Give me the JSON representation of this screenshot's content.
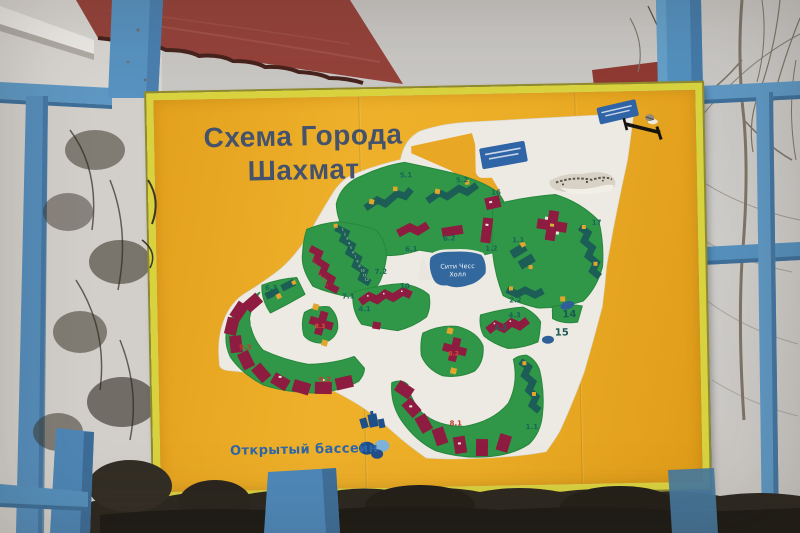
{
  "billboard": {
    "title_line1": "Схема Города",
    "title_line2": "Шахмат",
    "pool_label": "Открытый бассейн",
    "lake_label_line1": "Сити Чесс",
    "lake_label_line2": "Холл"
  },
  "map": {
    "block_labels": {
      "l51": "5.1",
      "l52": "5.2",
      "l16": "16",
      "l61": "6.1",
      "l62": "6.2",
      "l12": "1.2",
      "l72": "7.2",
      "l71": "7.1",
      "l63": "6.3",
      "l93": "9.3",
      "l92": "9.2",
      "l83": "8.3",
      "l10": "10",
      "l41": "4.1",
      "l82": "8.2",
      "l81": "8.1",
      "l11": "1.1",
      "l11b": "1.1",
      "l22": "2.2",
      "l17": "17",
      "l14": "14",
      "l15": "15",
      "l43": "4.3",
      "l43b": "4.3"
    },
    "units": [
      "1",
      "2",
      "3",
      "4",
      "5",
      "6",
      "7",
      "8",
      "9",
      "10",
      "11",
      "12"
    ]
  },
  "icons": {
    "pool_icon": "overlapping-pool-circles",
    "pool_building_icon": "building-silhouette",
    "direction_arrow": "black-direction-arrow",
    "bird_icon": "bird-on-arrow",
    "sign_a": "small-blue-sign-illegible",
    "sign_b": "small-blue-sign-illegible",
    "torn_patch": "damaged-board-surface"
  },
  "colors": {
    "board_face": "#e9a825",
    "board_frame": "#d9d23f",
    "title_text": "#44536b",
    "map_white": "#edeae3",
    "block_green": "#2f9747",
    "building_teal": "#1c5e55",
    "building_maroon": "#8e1c40",
    "accent_yellow": "#e2a52e",
    "lake_blue": "#33689f",
    "label_teal": "#19655a",
    "label_red": "#c23a30",
    "sign_blue": "#2f64a7",
    "pool_text_blue": "#2e66a8",
    "fence_blue": "#4e89ba",
    "roof_red": "#94423a",
    "sky_grey": "#c9c6c2",
    "foliage_dark": "#2c2820"
  }
}
